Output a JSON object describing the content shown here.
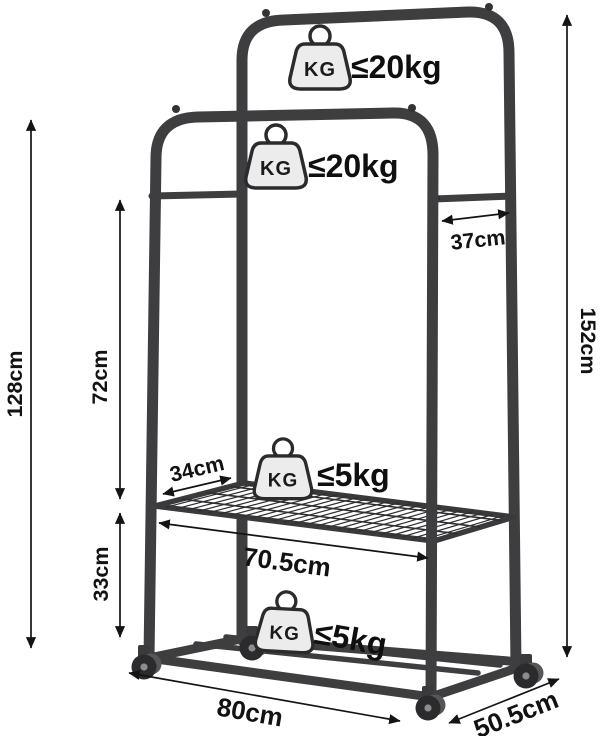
{
  "diagram": {
    "title": "garment-rack-dimension-diagram",
    "weight_icon_text": "KG",
    "weight_badges": [
      {
        "id": "top-rail",
        "label": "≤20kg"
      },
      {
        "id": "lower-rail",
        "label": "≤20kg"
      },
      {
        "id": "middle-shelf",
        "label": "≤5kg"
      },
      {
        "id": "bottom-shelf",
        "label": "≤5kg"
      }
    ],
    "measurements": {
      "total_height": "152cm",
      "side_height": "128cm",
      "bar_to_shelf": "72cm",
      "shelf_to_base": "33cm",
      "rail_offset": "37cm",
      "shelf_depth": "34cm",
      "shelf_width": "70.5cm",
      "base_width": "80cm",
      "base_depth": "50.5cm"
    },
    "colors": {
      "frame": "#3e3e41",
      "dimension_lines": "#141414",
      "badge_fill": "#ececec",
      "background": "#ffffff"
    }
  }
}
